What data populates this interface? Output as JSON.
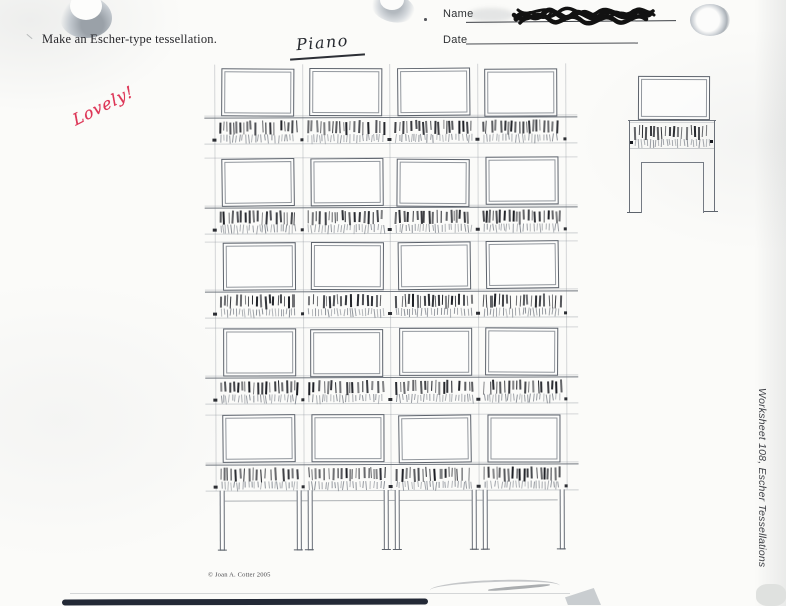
{
  "header": {
    "instruction": "Make an Escher-type tessellation.",
    "name_label": "Name",
    "date_label": "Date",
    "student_title": "Piano"
  },
  "annotations": {
    "teacher_note": "Lovely!"
  },
  "footer": {
    "copyright": "© Joan A. Cotter 2005",
    "side_label": "Worksheet 108, Escher Tessellations"
  },
  "colors": {
    "paper": "#fbfbf9",
    "pencil": "#5d636c",
    "pencil_mid": "#71777f",
    "pencil_faint": "rgba(150,156,164,0.38)",
    "key_ink": "#17191f",
    "key_lower": "#5a616c",
    "note_red": "#dd3657",
    "scribble_ink": "#121212",
    "bottom_bar": "#232936"
  },
  "drawing": {
    "grid": {
      "cols": 4,
      "rows": 5,
      "origin_x": 215,
      "origin_y": 68,
      "cell_w": 87.7,
      "row_offsets": [
        0,
        90,
        174,
        260,
        347
      ],
      "lid_w": 71,
      "lid_h": 46,
      "keys_top": 52,
      "keys_h": 22,
      "left_ext": 205,
      "right_ext": 578,
      "legs_top": 490,
      "legs_bottom": 549,
      "rail_y": 500
    },
    "sample": {
      "lid_x": 637,
      "lid_y": 76,
      "lid_w": 70,
      "lid_h": 42,
      "body_top": 120,
      "body_left": 629,
      "body_right": 714,
      "keys_x": 633,
      "keys_y": 125,
      "keys_w": 78,
      "opening_top": 162,
      "opening_left": 641,
      "opening_right": 703,
      "legs_bottom": 212
    }
  }
}
